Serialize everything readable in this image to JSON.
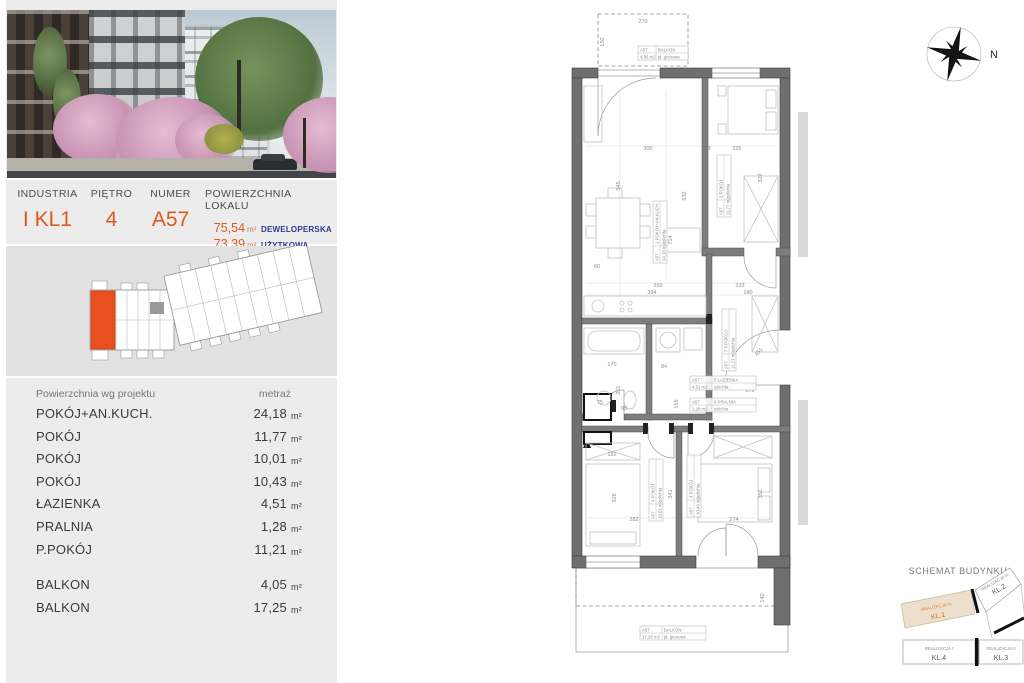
{
  "header": {
    "industria_label": "INDUSTRIA",
    "industria_value": "I KL1",
    "pietro_label": "PIĘTRO",
    "pietro_value": "4",
    "numer_label": "NUMER",
    "numer_value": "A57",
    "powierzchnia_label": "POWIERZCHNIA LOKALU",
    "area_dev_value": "75,54",
    "area_dev_unit": "m²",
    "area_dev_kind": "DEWELOPERSKA",
    "area_usable_value": "73,39",
    "area_usable_unit": "m²",
    "area_usable_kind": "UŻYTKOWA"
  },
  "area_table": {
    "header_name": "Powierzchnia wg projektu",
    "header_value": "metraż",
    "rows": [
      {
        "name": "POKÓJ+AN.KUCH.",
        "value": "24,18",
        "unit": "m²"
      },
      {
        "name": "POKÓJ",
        "value": "11,77",
        "unit": "m²"
      },
      {
        "name": "POKÓJ",
        "value": "10,01",
        "unit": "m²"
      },
      {
        "name": "POKÓJ",
        "value": "10,43",
        "unit": "m²"
      },
      {
        "name": "ŁAZIENKA",
        "value": "4,51",
        "unit": "m²"
      },
      {
        "name": "PRALNIA",
        "value": "1,28",
        "unit": "m²"
      },
      {
        "name": "P.POKÓJ",
        "value": "11,21",
        "unit": "m²"
      }
    ],
    "balcony_rows": [
      {
        "name": "BALKON",
        "value": "4,05",
        "unit": "m²"
      },
      {
        "name": "BALKON",
        "value": "17,25",
        "unit": "m²"
      }
    ]
  },
  "plan": {
    "labels": {
      "living": {
        "unit": "A57",
        "room": "1 POKÓJ+AN.KUCH",
        "area": "24,18 m2",
        "floor": "szlichta"
      },
      "room2": {
        "unit": "A57",
        "room": "2 POKÓJ",
        "area": "11,77 m2",
        "floor": "szlichta"
      },
      "room3": {
        "unit": "A57",
        "room": "3 POKÓJ",
        "area": "10,01 m2",
        "floor": "szlichta"
      },
      "room4": {
        "unit": "A57",
        "room": "4 POKÓJ",
        "area": "10,43 m2",
        "floor": "szlichta"
      },
      "bath": {
        "unit": "A57",
        "room": "5 ŁAZIENKA",
        "area": "4,51 m2",
        "floor": "szlichta"
      },
      "laundry": {
        "unit": "A57",
        "room": "6 PRALNIA",
        "area": "1,28 m2",
        "floor": "szlichta"
      },
      "hall": {
        "unit": "A57",
        "room": "7 P.POKÓJ",
        "area": "11,21 m2",
        "floor": "szlichta"
      },
      "balcony_top": {
        "unit": "A57",
        "room": "BALKON",
        "area": "4,05 m2",
        "floor": "pł. gresowe"
      },
      "balcony_bottom": {
        "unit": "A57",
        "room": "BALKON",
        "area": "17,25 m2",
        "floor": "pł. gresowe"
      }
    },
    "dims": {
      "d270": "270",
      "d150": "150",
      "d300": "300",
      "d8": "8",
      "d225": "225",
      "d545": "545",
      "d532": "532",
      "d714": "714",
      "d322": "322",
      "d60": "60",
      "d250": "250",
      "d233": "233",
      "d384": "384",
      "d180": "180",
      "d170": "170",
      "d84": "84",
      "d201": "201",
      "d155": "155",
      "d95": "95",
      "d75": "75",
      "d182": "182",
      "d451": "451",
      "d179": "179",
      "d282": "282",
      "d274": "274",
      "d328": "328",
      "d341": "341",
      "d351": "351",
      "d140": "140"
    }
  },
  "compass": {
    "north_label": "N"
  },
  "schemat": {
    "title": "SCHEMAT BUDYNKU",
    "blocks": [
      {
        "realizacja": "REALIZACJA IV",
        "kl": "KL.1"
      },
      {
        "realizacja": "REALIZACJA III",
        "kl": "KL.2"
      },
      {
        "realizacja": "REALIZACJA II",
        "kl": "KL.3"
      },
      {
        "realizacja": "REALIZACJA I",
        "kl": "KL.4"
      }
    ]
  },
  "colors": {
    "accent": "#e2571d",
    "navy": "#2b3a8f",
    "wall": "#6f6f6f",
    "locator_highlight": "#e8501e"
  }
}
